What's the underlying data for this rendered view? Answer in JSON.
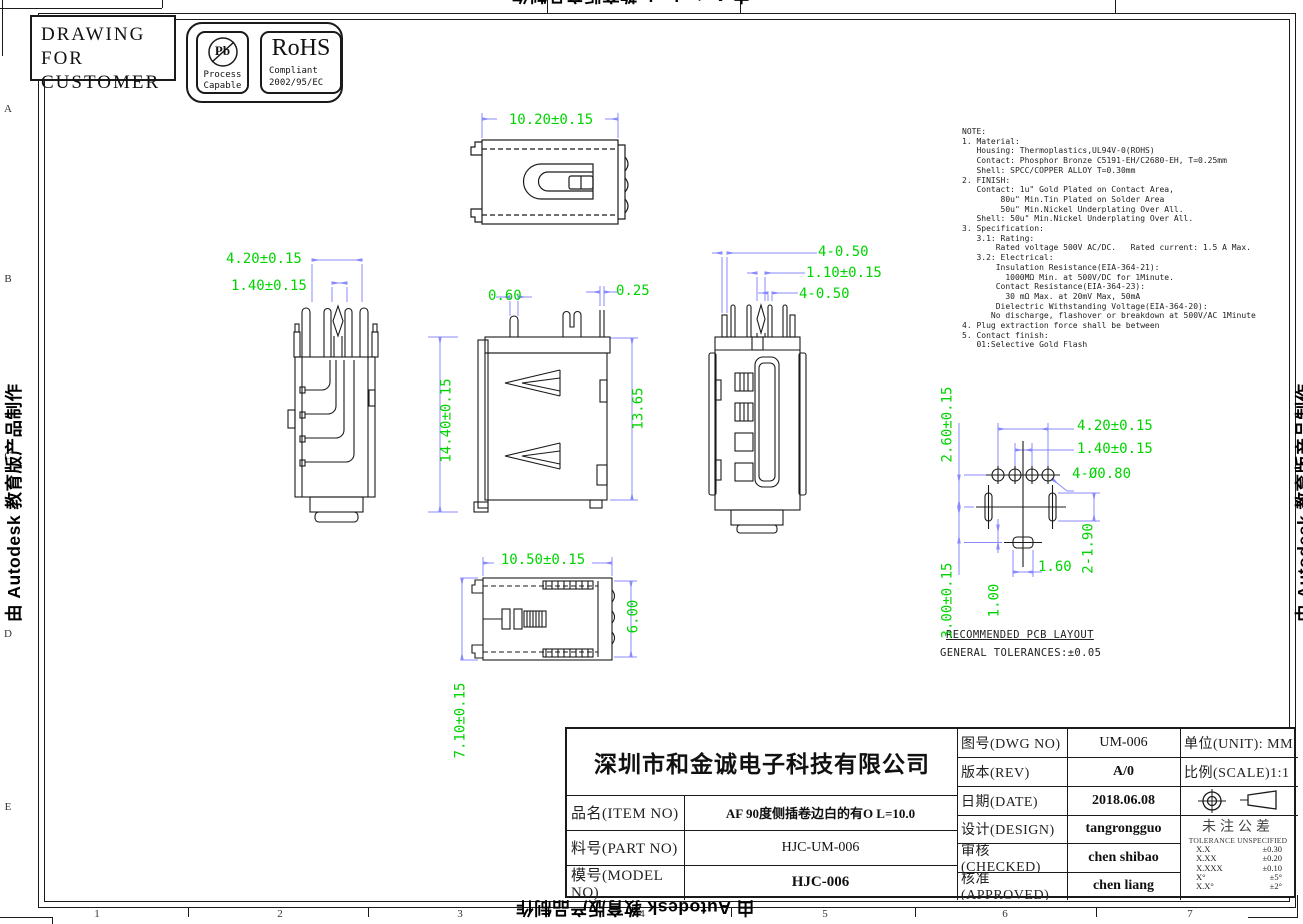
{
  "sheet": {
    "corner_note": {
      "line1": "DRAWING FOR",
      "line2": "CUSTOMER"
    },
    "badges": {
      "pb": {
        "symbol": "Pb",
        "caption1": "Process",
        "caption2": "Capable"
      },
      "rohs": {
        "title": "RoHS",
        "caption1": "Compliant",
        "caption2": "2002/95/EC"
      }
    },
    "grid": {
      "rows": [
        "A",
        "B",
        "C",
        "D",
        "E"
      ],
      "cols": [
        "1",
        "2",
        "3",
        "4",
        "5",
        "6",
        "7"
      ]
    },
    "watermark": "由 Autodesk 教育版产品制作"
  },
  "notes": {
    "text": "NOTE:\n1. Material:\n   Housing: Thermoplastics,UL94V-0(ROHS)\n   Contact: Phosphor Bronze C5191-EH/C2680-EH, T=0.25mm\n   Shell: SPCC/COPPER ALLOY T=0.30mm\n2. FINISH:\n   Contact: 1u\" Gold Plated on Contact Area,\n        80u\" Min.Tin Plated on Solder Area\n        50u\" Min.Nickel Underplating Over All.\n   Shell: 50u\" Min.Nickel Underplating Over All.\n3. Specification:\n   3.1: Rating:\n       Rated voltage 500V AC/DC.   Rated current: 1.5 A Max.\n   3.2: Electrical:\n       Insulation Resistance(EIA-364-21):\n         1000MΩ Min. at 500V/DC for 1Minute.\n       Contact Resistance(EIA-364-23):\n         30 mΩ Max. at 20mV Max, 50mA\n       Dielectric Withstanding Voltage(EIA-364-20):\n      No discharge, flashover or breakdown at 500V/AC 1Minute\n4. Plug extraction force shall be between\n5. Contact finish:\n   01:Selective Gold Flash"
  },
  "dims": {
    "top_width": "10.20±0.15",
    "side_pitch": "4.20±0.15",
    "side_pitch2": "1.40±0.15",
    "side_height": "14.40±0.15",
    "front_pin_w": "0.60",
    "front_pin_w2": "0.25",
    "front_height": "13.65",
    "rear_d1": "4-0.50",
    "rear_d2": "1.10±0.15",
    "rear_d3": "4-0.50",
    "bottom_width": "10.50±0.15",
    "bottom_h": "6.00",
    "bottom_depth": "7.10±0.15",
    "pcb_pitch": "4.20±0.15",
    "pcb_pitch2": "1.40±0.15",
    "pcb_hole": "4-Ø0.80",
    "pcb_v1": "2.60±0.15",
    "pcb_v2": "3.00±0.15",
    "pcb_v3": "1.00",
    "pcb_w": "1.60",
    "pcb_slot": "2-1.90"
  },
  "pcb": {
    "title": "RECOMMENDED PCB LAYOUT",
    "tolerance": "GENERAL TOLERANCES:±0.05"
  },
  "title_block": {
    "company": "深圳市和金诚电子科技有限公司",
    "item": {
      "label": "品名(ITEM NO)",
      "value": "AF 90度侧插卷边白的有O L=10.0"
    },
    "part": {
      "label": "料号(PART NO)",
      "value": "HJC-UM-006"
    },
    "model": {
      "label": "模号(MODEL NO)",
      "value": "HJC-006"
    },
    "dwg": {
      "label": "图号(DWG NO)",
      "value": "UM-006"
    },
    "rev": {
      "label": "版本(REV)",
      "value": "A/0"
    },
    "date": {
      "label": "日期(DATE)",
      "value": "2018.06.08"
    },
    "design": {
      "label": "设计(DESIGN)",
      "value": "tangrongguo"
    },
    "checked": {
      "label": "审核(CHECKED)",
      "value": "chen shibao"
    },
    "approved": {
      "label": "核准(APPROVED)",
      "value": "chen liang"
    },
    "unit": "单位(UNIT): MM",
    "scale": "比例(SCALE)1:1",
    "tolerance": {
      "title_cn": "未注公差",
      "title_en": "TOLERANCE UNSPECIFIED",
      "entries": [
        {
          "k": "X.X",
          "v": "±0.30"
        },
        {
          "k": "X.XX",
          "v": "±0.20"
        },
        {
          "k": "X.XXX",
          "v": "±0.10"
        },
        {
          "k": "X°",
          "v": "±5°"
        },
        {
          "k": "X.X°",
          "v": "±2°"
        }
      ]
    }
  },
  "colors": {
    "dim_text": "#00d400",
    "dim_line": "#8a8aff",
    "line": "#1a1a1a"
  }
}
